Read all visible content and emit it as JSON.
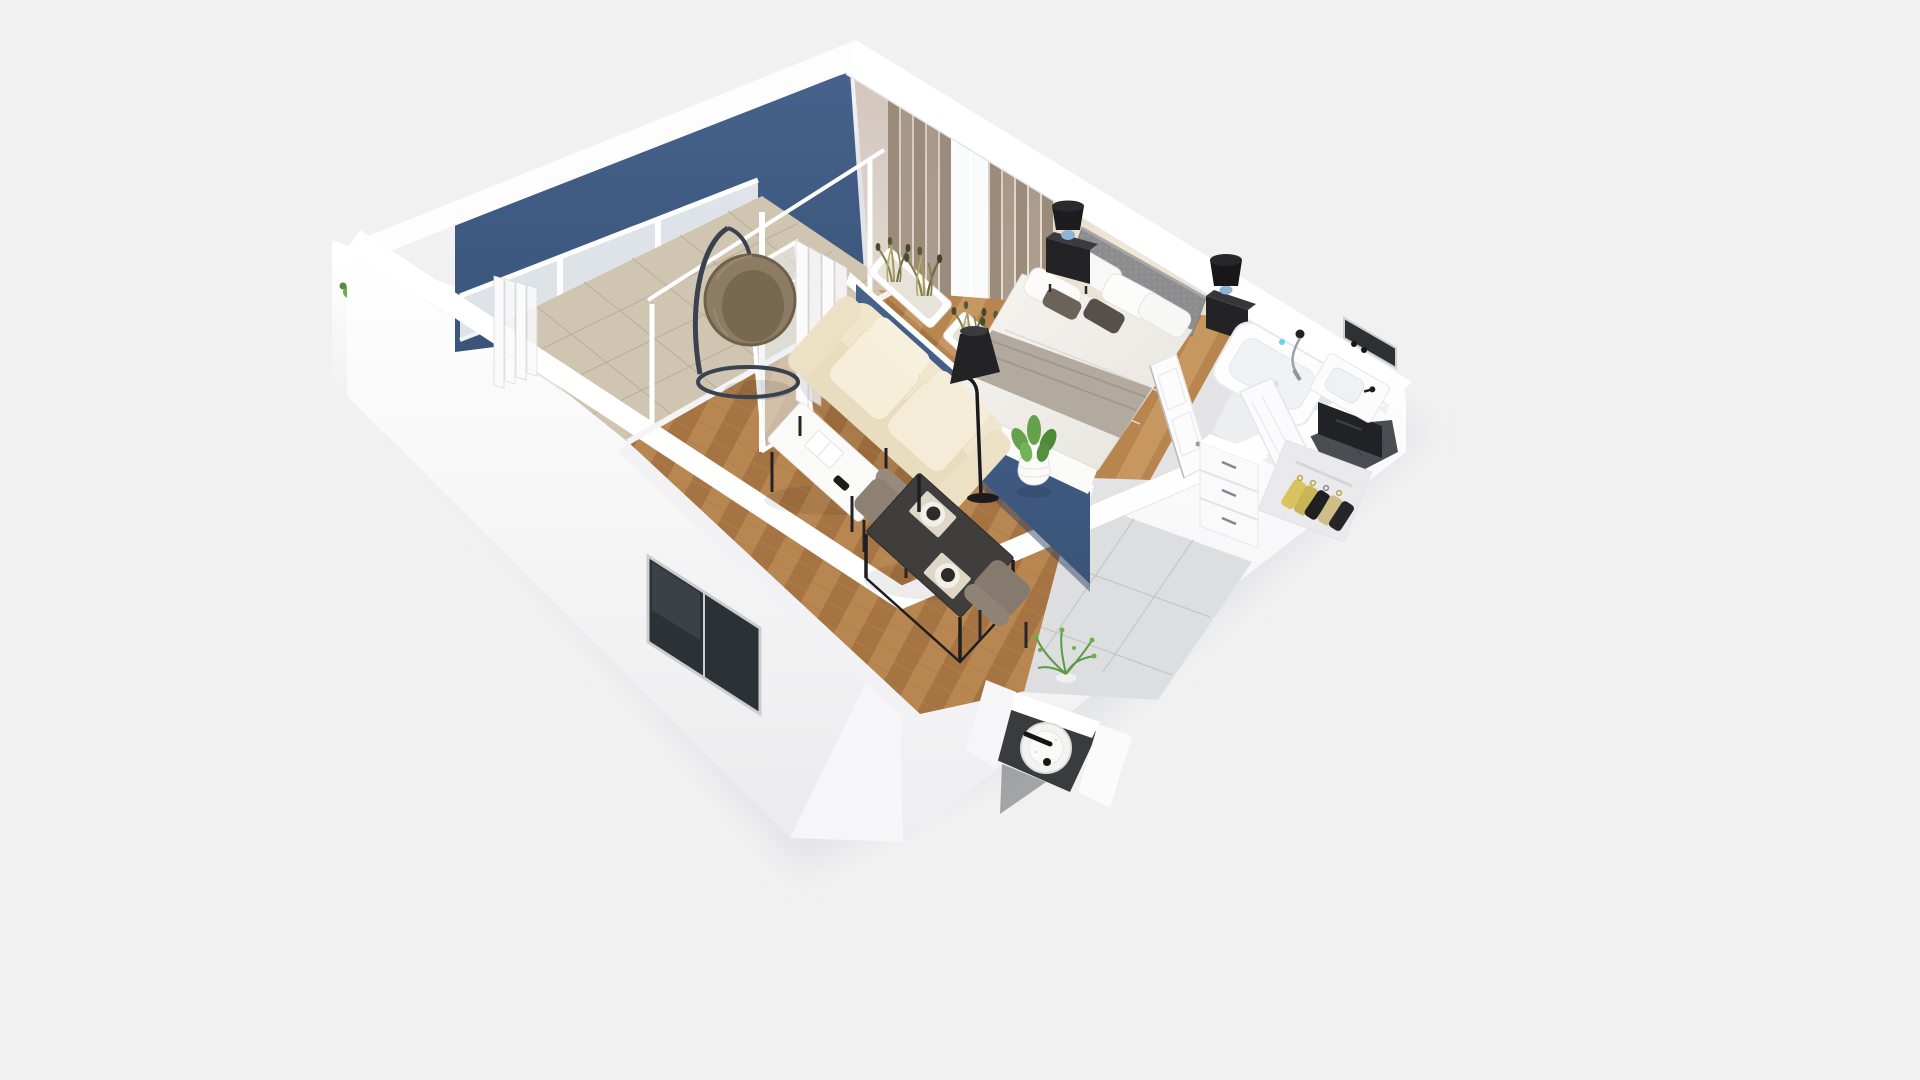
{
  "scene": {
    "title": "Isometric 3D cutaway floor plan of a one-bedroom apartment with balcony",
    "type": "3d-floorplan-render",
    "view": "top-down isometric cutaway (no roof)",
    "background_color": "#f1f1f2",
    "palette": {
      "wall_white": "#ffffff",
      "wall_shade": "#ececee",
      "accent_blue_top": "#46628c",
      "accent_blue_bottom": "#3a5479",
      "accent_blue_wall": "#3e5a7d",
      "bedroom_wall_beige": "#d2c6bd",
      "wood_dark": "#aa7845",
      "wood_light": "#bd8b55",
      "balcony_tile": "#cfc5b0",
      "hall_tile": "#dcdee0",
      "bathroom_dark_floor": "#4a4e52",
      "curtain_taupe": "#9b8b7b",
      "curtain_white": "#fbfbfc",
      "sofa_cream": "#f0e6cc",
      "lamp_black": "#232326",
      "table_dark": "#3f3e3c",
      "chair_taupe": "#8d8174",
      "plant_green": "#66a14b",
      "grass_olive": "#a79a5e",
      "clothes_yellow": "#d9c35f",
      "headboard_grey": "#8d8d8f",
      "throw_grey": "#b2a99f",
      "window_glazing": "#2c3135"
    },
    "rooms": [
      {
        "name": "balcony",
        "floor": "beige ceramic tile",
        "items": [
          "hanging egg chair",
          "sheer white curtains",
          "sliding glass doors"
        ]
      },
      {
        "name": "living-room",
        "floor": "oak herringbone parquet",
        "items": [
          "cream three-seat sofa",
          "white coffee table with magazine and remote",
          "black cone floor lamp",
          "dining table for two with two place settings",
          "two taupe dining chairs",
          "potted plant in white vase",
          "planter room divider with dried grasses",
          "blue accent wall"
        ]
      },
      {
        "name": "bedroom",
        "floor": "oak parquet",
        "items": [
          "double bed with grey headboard",
          "grey bed runner",
          "white pillows and two dark accent pillows",
          "two black nightstands",
          "two black table lamps with blue glass base",
          "taupe curtains",
          "window"
        ]
      },
      {
        "name": "bathroom",
        "floor": "white tile with dark grey tile section",
        "items": [
          "built-in bathtub with chrome shower set",
          "white washbasin on black vanity",
          "dark wall mirror",
          "patterned tile accent wall",
          "white bathroom door"
        ]
      },
      {
        "name": "hallway",
        "floor": "large light grey tiles",
        "items": [
          "white drawer chest",
          "potted fern",
          "open wardrobe with hanging clothes",
          "white bedroom door"
        ]
      },
      {
        "name": "wc-niche",
        "floor": "dark grey tile",
        "items": [
          "round white basin fixture with black faucet"
        ]
      }
    ]
  }
}
